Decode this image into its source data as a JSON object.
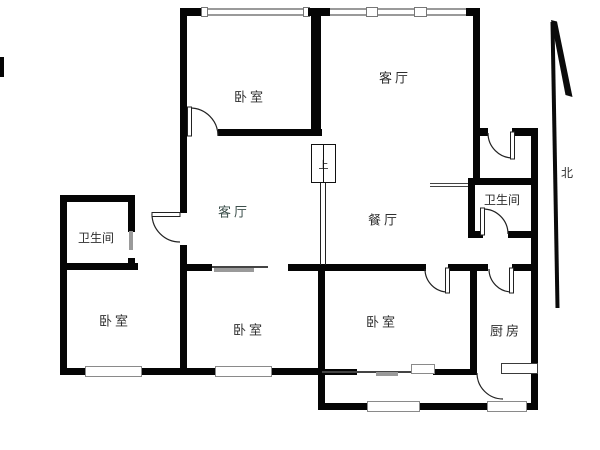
{
  "meta": {
    "background_color": "#ffffff",
    "wall_color": "#050505",
    "window_color": "#9a9a9a",
    "diagram_type": "apartment floor plan"
  },
  "rooms": [
    {
      "id": "bedroom-top",
      "label": "卧室"
    },
    {
      "id": "living-room-a",
      "label": "客厅"
    },
    {
      "id": "living-room-b",
      "label": "客厅"
    },
    {
      "id": "dining-room",
      "label": "餐厅"
    },
    {
      "id": "bathroom-left",
      "label": "卫生间"
    },
    {
      "id": "bathroom-right",
      "label": "卫生间"
    },
    {
      "id": "bedroom-left",
      "label": "卧室"
    },
    {
      "id": "bedroom-middle",
      "label": "卧室"
    },
    {
      "id": "bedroom-right",
      "label": "卧室"
    },
    {
      "id": "kitchen",
      "label": "厨房"
    }
  ],
  "compass": {
    "label": "北"
  },
  "stairs": {
    "label": "上"
  }
}
